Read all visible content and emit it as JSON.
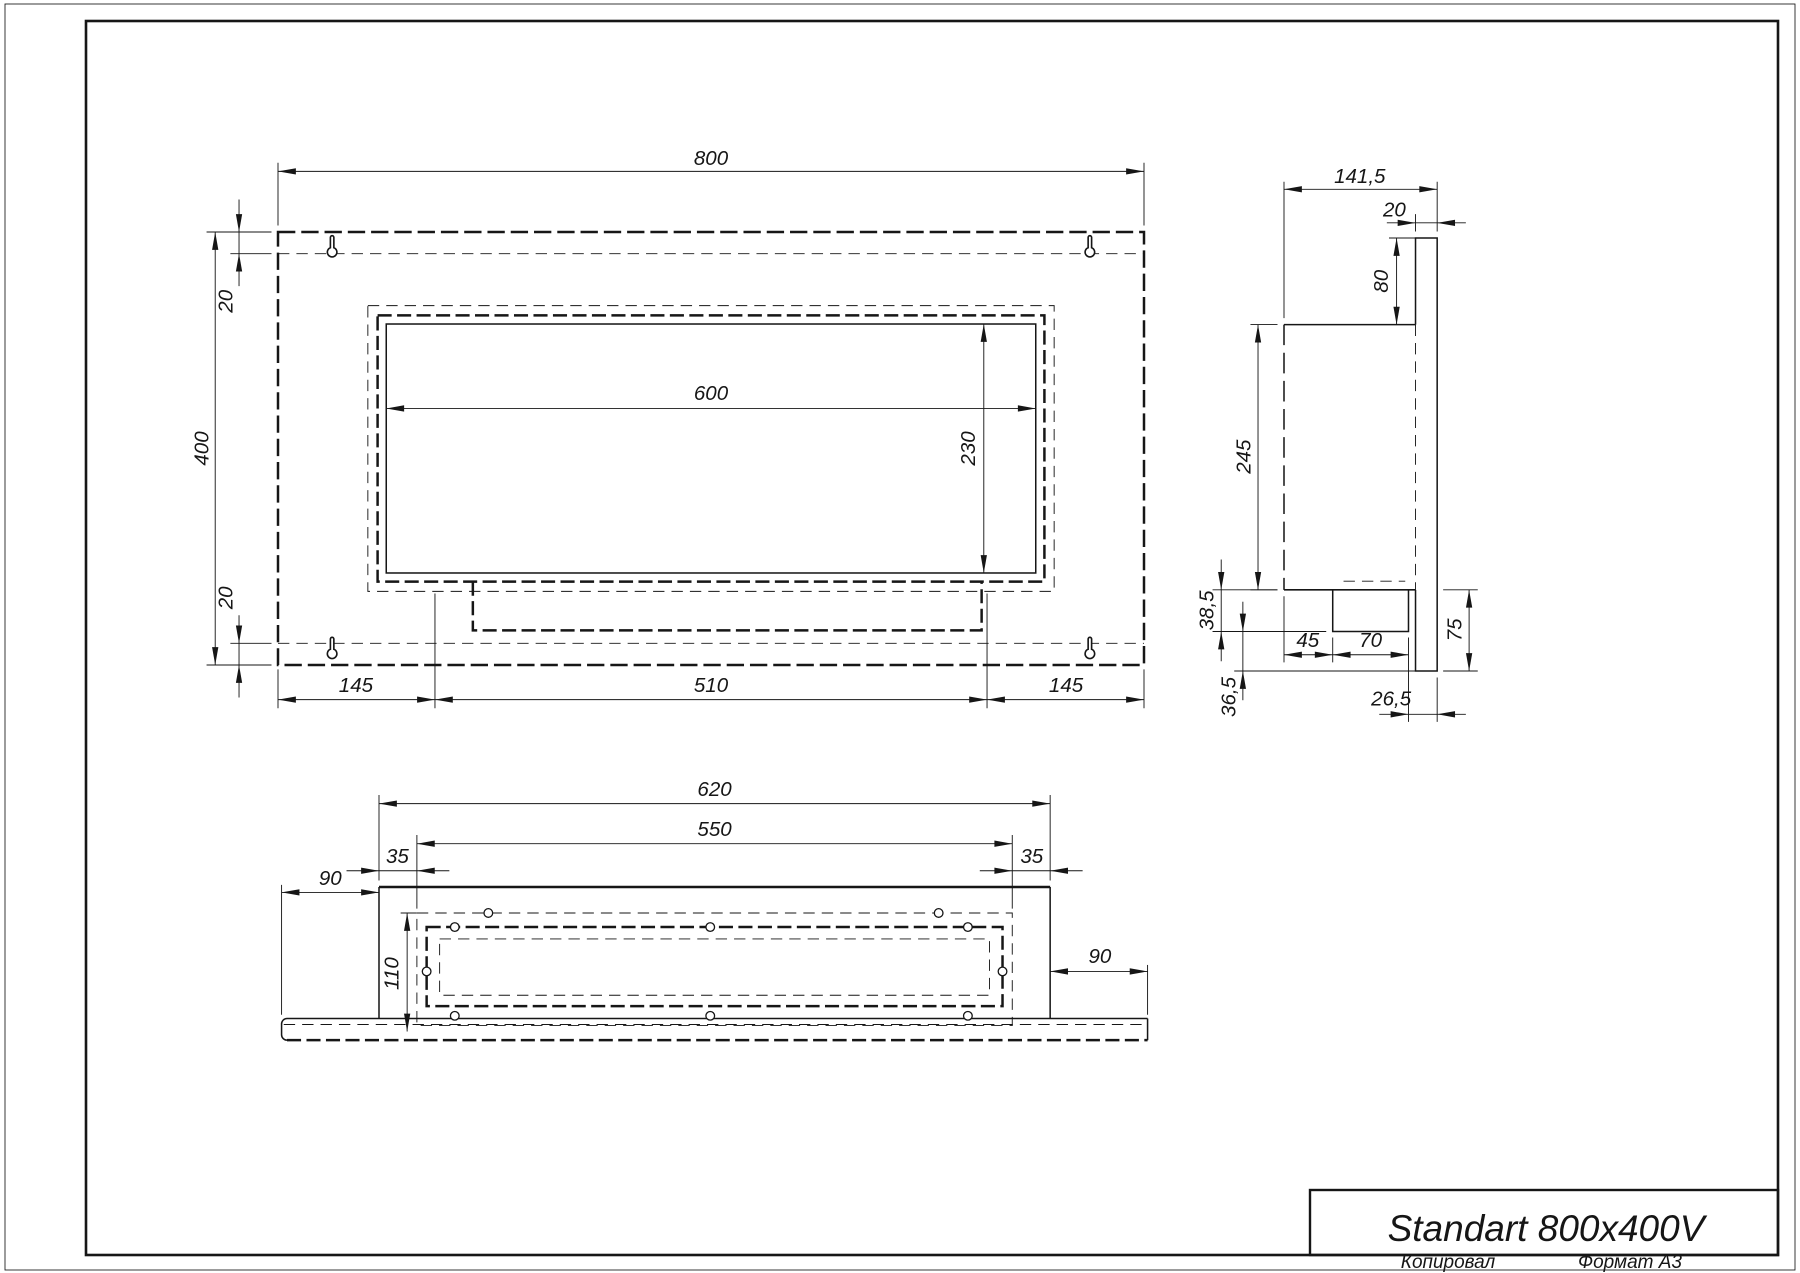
{
  "sheet": {
    "copied_label": "Копировал",
    "format_label": "Формат А3"
  },
  "title_block": {
    "title": "Standart 800x400V"
  },
  "front_view": {
    "dims": {
      "width": "800",
      "height": "400",
      "inset_top": "20",
      "inset_bottom": "20",
      "opening_width": "600",
      "opening_height": "230",
      "bottom_left": "145",
      "bottom_center": "510",
      "bottom_right": "145"
    }
  },
  "side_view": {
    "dims": {
      "width": "141,5",
      "plate_thickness": "20",
      "plate_above_box": "80",
      "box_height": "245",
      "tray_depth": "38,5",
      "plate_below_tray": "36,5",
      "tray_offset": "45",
      "tray_width": "70",
      "tray_to_back_edge": "26,5",
      "plate_below_box": "75"
    }
  },
  "bottom_view": {
    "dims": {
      "width": "620",
      "opening_width": "550",
      "margin_left": "35",
      "margin_right": "35",
      "flange_left": "90",
      "flange_right": "90",
      "depth": "110"
    }
  }
}
